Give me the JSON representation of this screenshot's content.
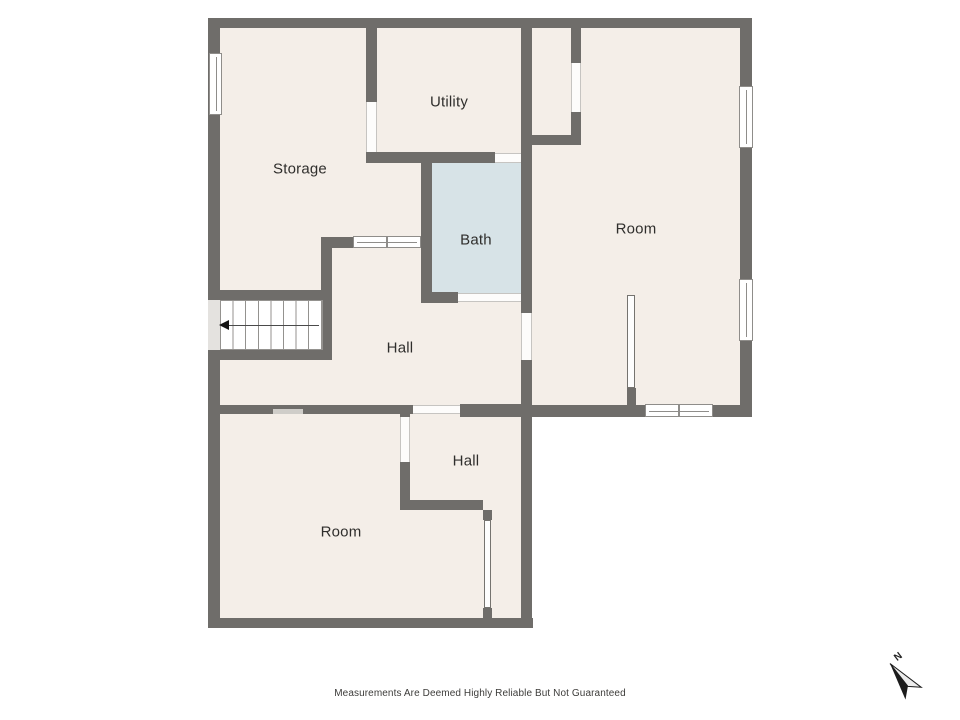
{
  "plan": {
    "rooms": [
      {
        "id": "storage",
        "label": "Storage"
      },
      {
        "id": "utility",
        "label": "Utility"
      },
      {
        "id": "bath",
        "label": "Bath"
      },
      {
        "id": "room-right",
        "label": "Room"
      },
      {
        "id": "hall-main",
        "label": "Hall"
      },
      {
        "id": "hall-small",
        "label": "Hall"
      },
      {
        "id": "room-bottom",
        "label": "Room"
      }
    ],
    "stairs": {
      "arrow_direction": "left"
    },
    "compass": {
      "north_label": "N"
    }
  },
  "footer": {
    "disclaimer": "Measurements Are Deemed Highly Reliable But Not Guaranteed"
  },
  "colors": {
    "wall": "#6f6d6a",
    "floor": "#f4eee8",
    "bath_floor": "#d7e3e7",
    "background": "#ffffff",
    "stair_void": "#e4e2df",
    "text": "#2f2e2c"
  }
}
